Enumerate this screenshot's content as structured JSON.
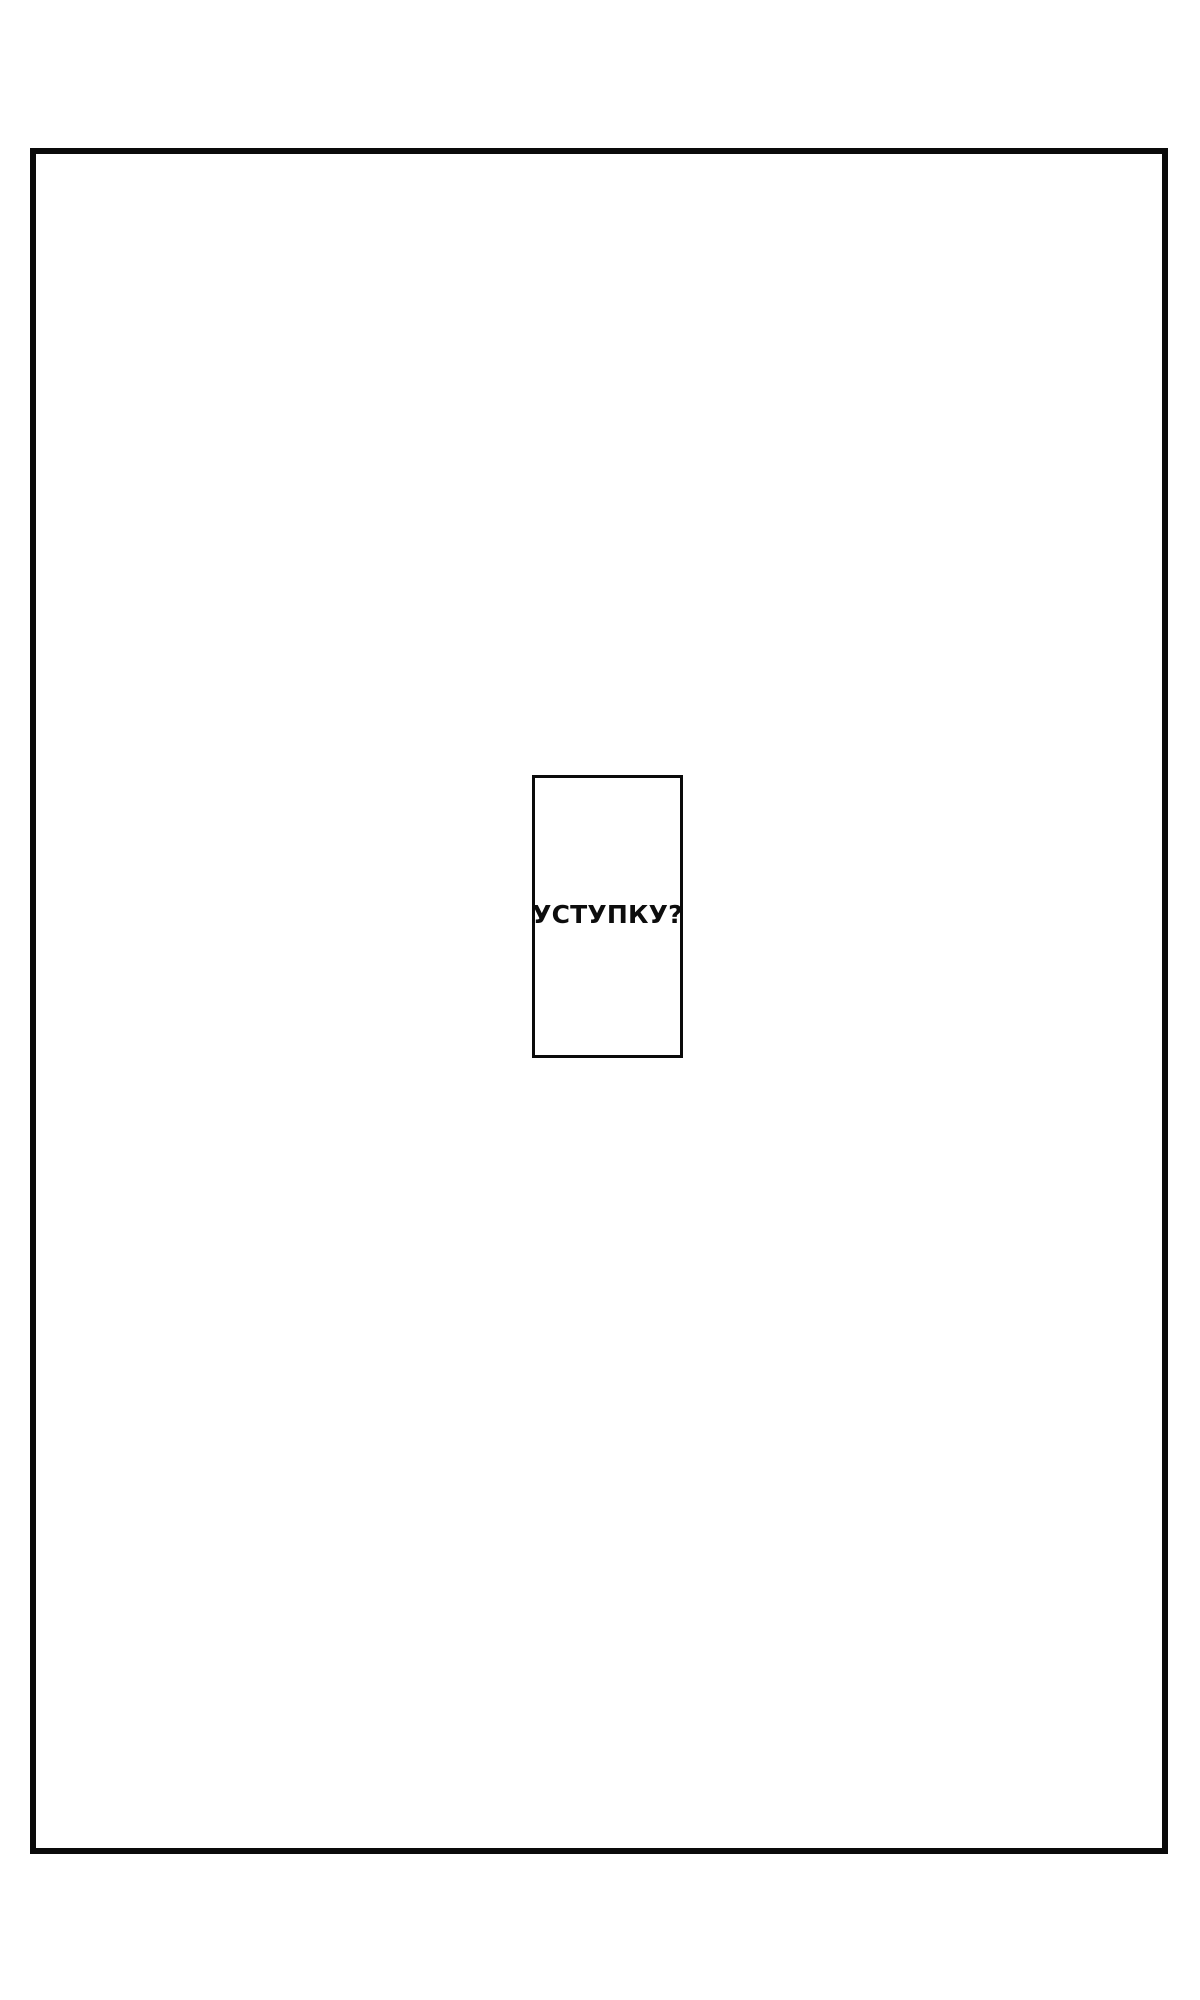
{
  "page": {
    "kind": "comic-page",
    "background_color": "#ffffff"
  },
  "panel": {
    "border_color": "#0a0a0a"
  },
  "caption": {
    "text": "УСТУПКУ?",
    "text_color": "#0d0d0d",
    "border_color": "#0a0a0a"
  }
}
